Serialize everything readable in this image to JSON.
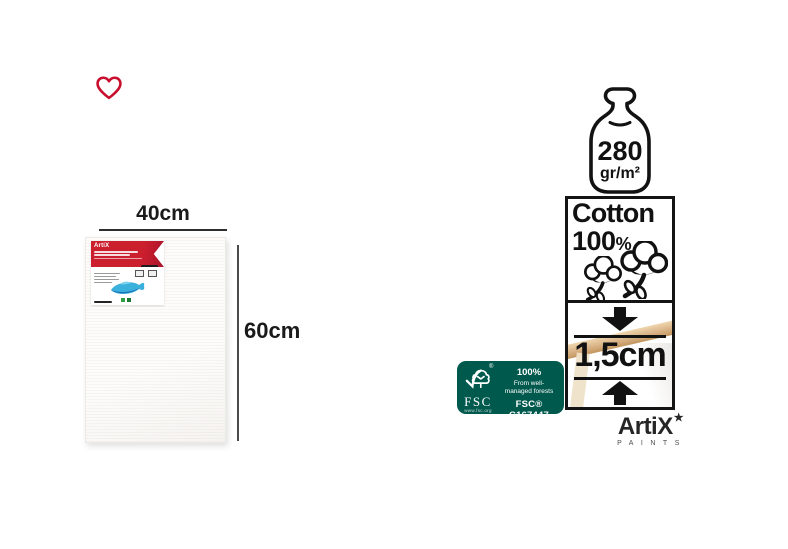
{
  "page": {
    "background": "#ffffff"
  },
  "wishlist": {
    "color": "#c8102e"
  },
  "dimensions": {
    "width": "40cm",
    "height": "60cm"
  },
  "package_label": {
    "brand": "ArtiX"
  },
  "specs": {
    "weight": {
      "value": "280",
      "unit": "gr/m²"
    },
    "cotton": {
      "word": "Cotton",
      "value": "100",
      "percent_sign": "%"
    },
    "depth": {
      "value": "1,5cm"
    }
  },
  "fsc": {
    "acronym": "FSC",
    "url": "www.fsc.org",
    "percent": "100%",
    "line1": "From well-",
    "line2": "managed forests",
    "code": "FSC® C167447",
    "color": "#00594d"
  },
  "brand": {
    "name": "ArtiX",
    "star": "★",
    "tagline": "PAINTS"
  }
}
